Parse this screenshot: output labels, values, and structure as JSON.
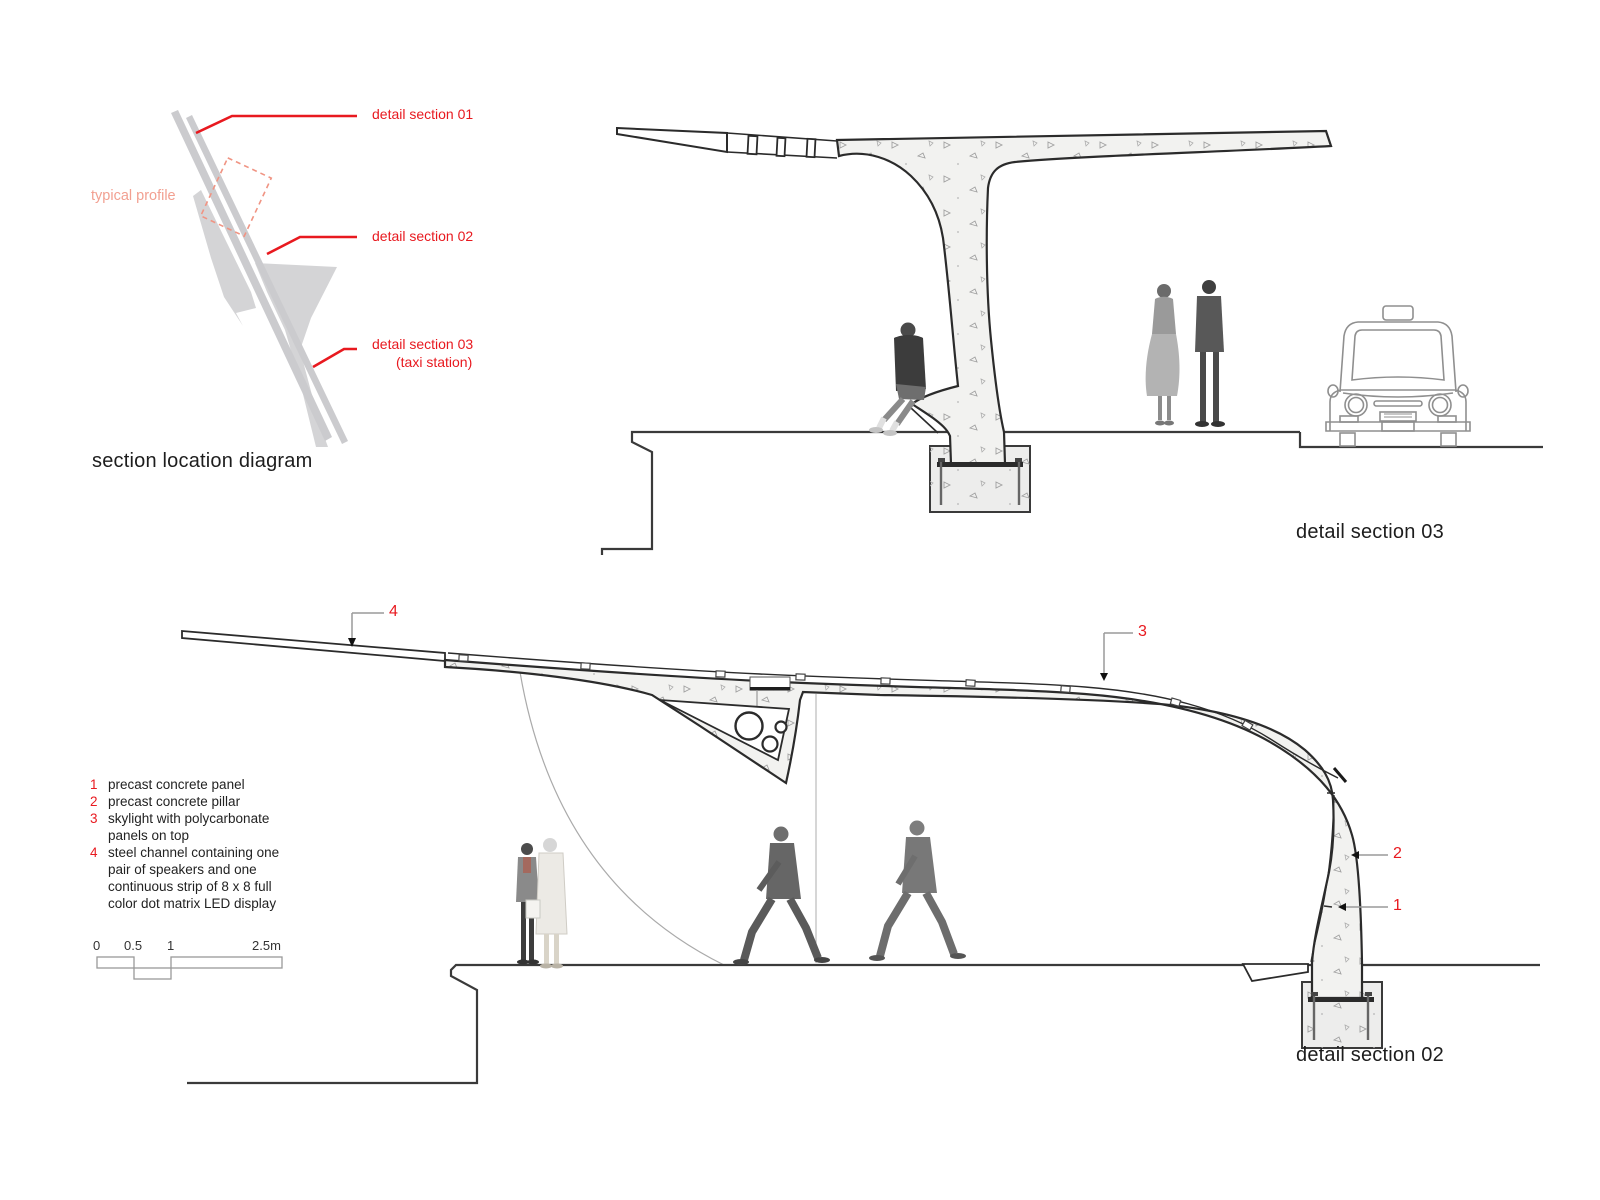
{
  "location_diagram": {
    "title": "section location diagram",
    "profile_label": "typical profile",
    "callouts": [
      {
        "label": "detail section 01"
      },
      {
        "label": "detail section 02"
      },
      {
        "label": "detail section 03",
        "sublabel": "(taxi station)"
      }
    ]
  },
  "section03": {
    "title": "detail section 03"
  },
  "section02": {
    "title": "detail section 02",
    "callouts": {
      "c1": "1",
      "c2": "2",
      "c3": "3",
      "c4": "4"
    },
    "legend": [
      {
        "num": "1",
        "text": "precast concrete panel"
      },
      {
        "num": "2",
        "text": "precast concrete pillar"
      },
      {
        "num": "3",
        "text": "skylight with polycarbonate panels on top"
      },
      {
        "num": "4",
        "text": "steel channel containing one pair of speakers and one continuous strip of 8 x 8 full color dot matrix LED display"
      }
    ],
    "scale_bar": {
      "ticks": [
        "0",
        "0.5",
        "1",
        "2.5m"
      ]
    }
  },
  "colors": {
    "red": "#e8191f",
    "salmon": "#f2a091",
    "map_gray": "#d4d4d6",
    "concrete": "#f2f2f0",
    "line": "#2b2b2b"
  }
}
